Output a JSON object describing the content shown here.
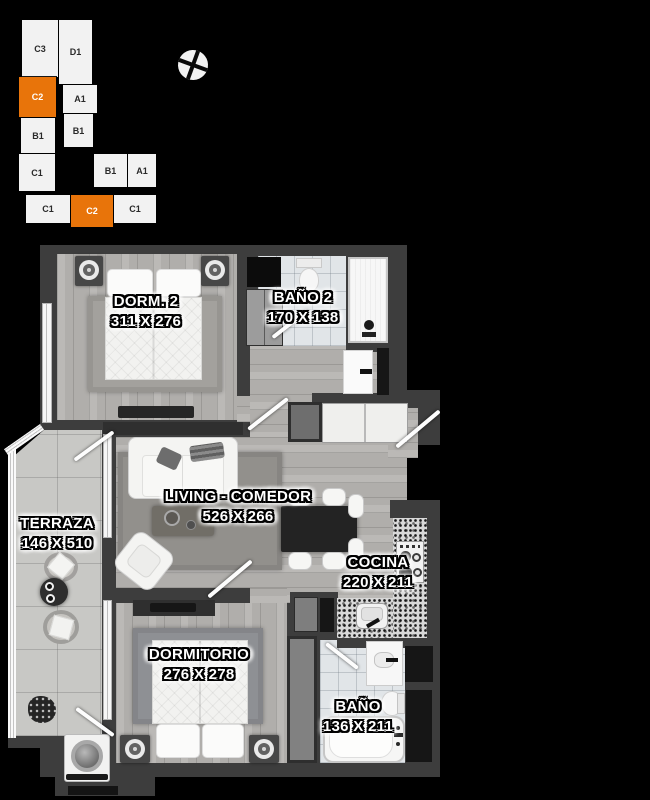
{
  "palette": {
    "background": "#000000",
    "wall": "#3d3d3d",
    "accent_orange": "#e8740a"
  },
  "key_plan": {
    "units": [
      {
        "label": "C3",
        "highlighted": false
      },
      {
        "label": "D1",
        "highlighted": false
      },
      {
        "label": "C2",
        "highlighted": true
      },
      {
        "label": "A1",
        "highlighted": false
      },
      {
        "label": "B1",
        "highlighted": false
      },
      {
        "label": "B1",
        "highlighted": false
      },
      {
        "label": "C1",
        "highlighted": false
      },
      {
        "label": "B1",
        "highlighted": false
      },
      {
        "label": "A1",
        "highlighted": false
      },
      {
        "label": "C1",
        "highlighted": false
      },
      {
        "label": "C2",
        "highlighted": true
      },
      {
        "label": "C1",
        "highlighted": false
      }
    ]
  },
  "compass": {
    "icon": "compass-rose"
  },
  "rooms": [
    {
      "name": "DORM. 2",
      "dims": "311 X 276"
    },
    {
      "name": "BAÑO 2",
      "dims": "170 X 138"
    },
    {
      "name": "TERRAZA",
      "dims": "146 X 510"
    },
    {
      "name": "LIVING - COMEDOR",
      "dims": "526 X 266"
    },
    {
      "name": "COCINA",
      "dims": "220 X 211"
    },
    {
      "name": "DORMITORIO",
      "dims": "276 X 278"
    },
    {
      "name": "BAÑO",
      "dims": "136 X 211"
    }
  ]
}
